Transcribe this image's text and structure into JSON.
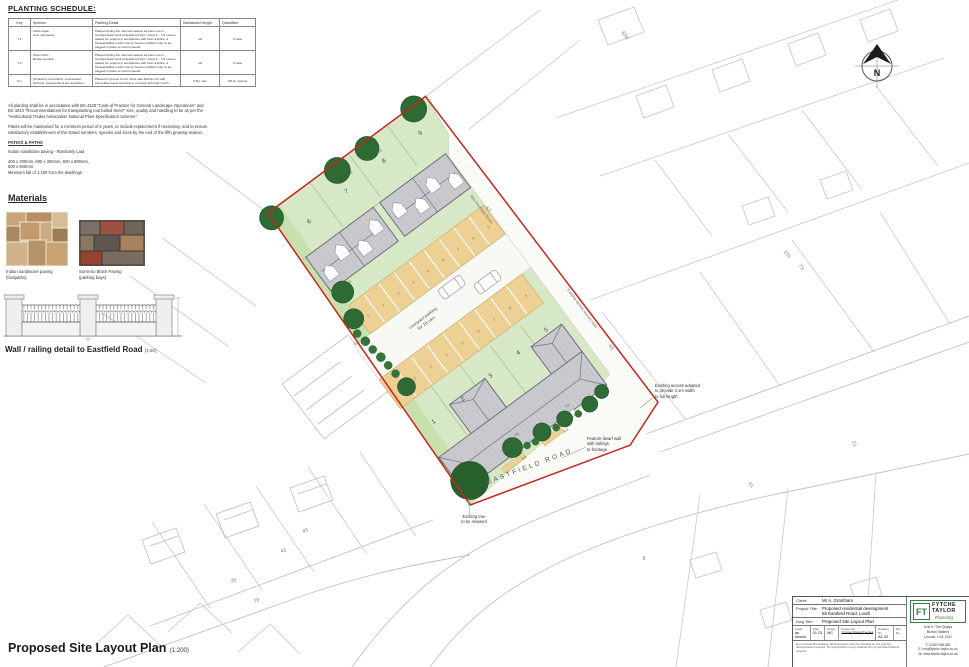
{
  "colors": {
    "boundary_red": "#c3271c",
    "garden_green": "#d6e8c5",
    "parking_tan": "#edd094",
    "roof_grey": "#c9c9cf",
    "tree_green": "#2e6b34",
    "logo_green": "#3a7d44"
  },
  "planting_schedule": {
    "heading": "PLANTING SCHEDULE:",
    "columns": [
      "Key",
      "Species",
      "Planting Detail",
      "Maintained Height",
      "Quantities"
    ],
    "rows": [
      {
        "key": "T.1",
        "species": "Field maple\nAcer campestre",
        "detail": "Planted during the dormant season as bare root or containerised stock of feathered form, sized 2 – 2.5 metres, staked for support in accordance with best practice; a biodegradable mulch mat of minimum 500mm dia. to be pegged in place to control weeds.",
        "height": "n/a",
        "qty": "6 total"
      },
      {
        "key": "T.2",
        "species": "Silver birch\nBetula pendula",
        "detail": "Planted during the dormant season as bare root or containerised stock of feathered form, sized 2 – 2.5 metres, staked for support in accordance with best practice; a biodegradable mulch mat of minimum 500mm dia. to be pegged in place to control weeds.",
        "height": "n/a",
        "qty": "5 total"
      },
      {
        "key": "S.1",
        "species": "Shrubbery comprising: cotoneaster, berberis, pyracantha & ilex aquifolium",
        "detail": "Planted in groups of min 10 at max 600mm c/c with permeable weed membrane, covered with bark mulch.",
        "height": "0.8m max",
        "qty": "(26 lin metres)"
      }
    ]
  },
  "notes": {
    "p1": "All planting shall be in accordance with BS 4428 \"Code of Practice for General Landscape Operations\" and BS 4043 \"Recommendations for transplanting root balled trees\"; size, quality and handling to be as per the \"Horticultural Trades Association National Plant Specification Scheme\".",
    "p2": "Plants will be maintained for a minimum period of 5 years, to include replacement if necessary, and to ensure satisfactory establishment of the stated numbers, species and sizes by the end of the fifth growing season.",
    "patios_heading": "PATIOS & PATHS",
    "patios_line1": "Indian sandstone paving - Randomly Laid",
    "patios_line2": "400 x 300mm, 600 x 300mm, 600 x 600mm,\n600 x 900mm.\nMinimum fall of 1:100 from the dwellings"
  },
  "materials": {
    "heading": "Materials",
    "item1_name": "Indian sandstone paving",
    "item1_sub": "(footpaths)",
    "item2_name": "Sorrento Block Paving",
    "item2_sub": "(parking bays)"
  },
  "wall_detail": {
    "caption": "Wall / railing detail to Eastfield Road",
    "scale": "(1:50)"
  },
  "footer": {
    "title": "Proposed Site Layout Plan",
    "scale": "(1:200)"
  },
  "plan": {
    "road_label": "EASTFIELD ROAD",
    "courtyard_line1": "courtyard parking",
    "courtyard_line2": "for 18 cars",
    "lane_label_upper": "New boundary fence",
    "lane_label_lower": "Existing tarmac access road",
    "ann_access": "Existing access adapted\nto provide 4.1m width\nto full length",
    "ann_wall": "Feature dwarf wall\nwith railings\nto frontage",
    "ann_tree": "Existing tree\nto be retained",
    "plots": [
      "1",
      "2",
      "3",
      "4",
      "5",
      "6",
      "7",
      "8",
      "9"
    ],
    "bays": [
      "1",
      "2",
      "3",
      "4",
      "5",
      "6",
      "7",
      "8",
      "9",
      "1",
      "2",
      "3",
      "4",
      "5",
      "6",
      "7",
      "8",
      "9"
    ],
    "tree_labels": [
      "T.1",
      "T.1",
      "T.1",
      "T.2",
      "T.2",
      "S.1",
      "S.1",
      "S.1"
    ],
    "map_numbers": [
      "63a",
      "57",
      "109",
      "73",
      "65",
      "21",
      "61",
      "8",
      "39",
      "43",
      "45",
      "29"
    ],
    "compass": "N"
  },
  "title_block": {
    "client_label": "Client:",
    "client": "Mr A. Grantham",
    "project_label": "Project Title:",
    "project": "Proposed residential development\n55 Eastfield Road, Louth",
    "dwg_label": "Dwg Title:",
    "dwg": "Proposed Site Layout Plan",
    "scale_label": "Scale:",
    "scale": "as shown",
    "date_label": "Date:",
    "date": "01.23",
    "drawn_label": "Drawn:",
    "drawn": "MC",
    "project_no_label": "Project No.",
    "project_no": "234/AGRANTHAM",
    "drawing_no_label": "Drawing No.",
    "drawing_no": "A1-02",
    "rev_label": "Rev No.",
    "disclaimer": "Do not scale this drawing. All dimensions must be checked on site and any discrepancies reported. No reproduction in any material form is permitted without consent.",
    "logo_monogram": "FT",
    "logo_line1": "FYTCHE",
    "logo_line2": "TAYLOR",
    "logo_line3": "Planning",
    "address": "Unit 5, The Quays\nBurton Waters\nLincoln, LN1 2XG",
    "contact": "T: 01522 581383\nE: info@fytche-taylor.co.uk\nW: www.fytche-taylor.co.uk"
  }
}
